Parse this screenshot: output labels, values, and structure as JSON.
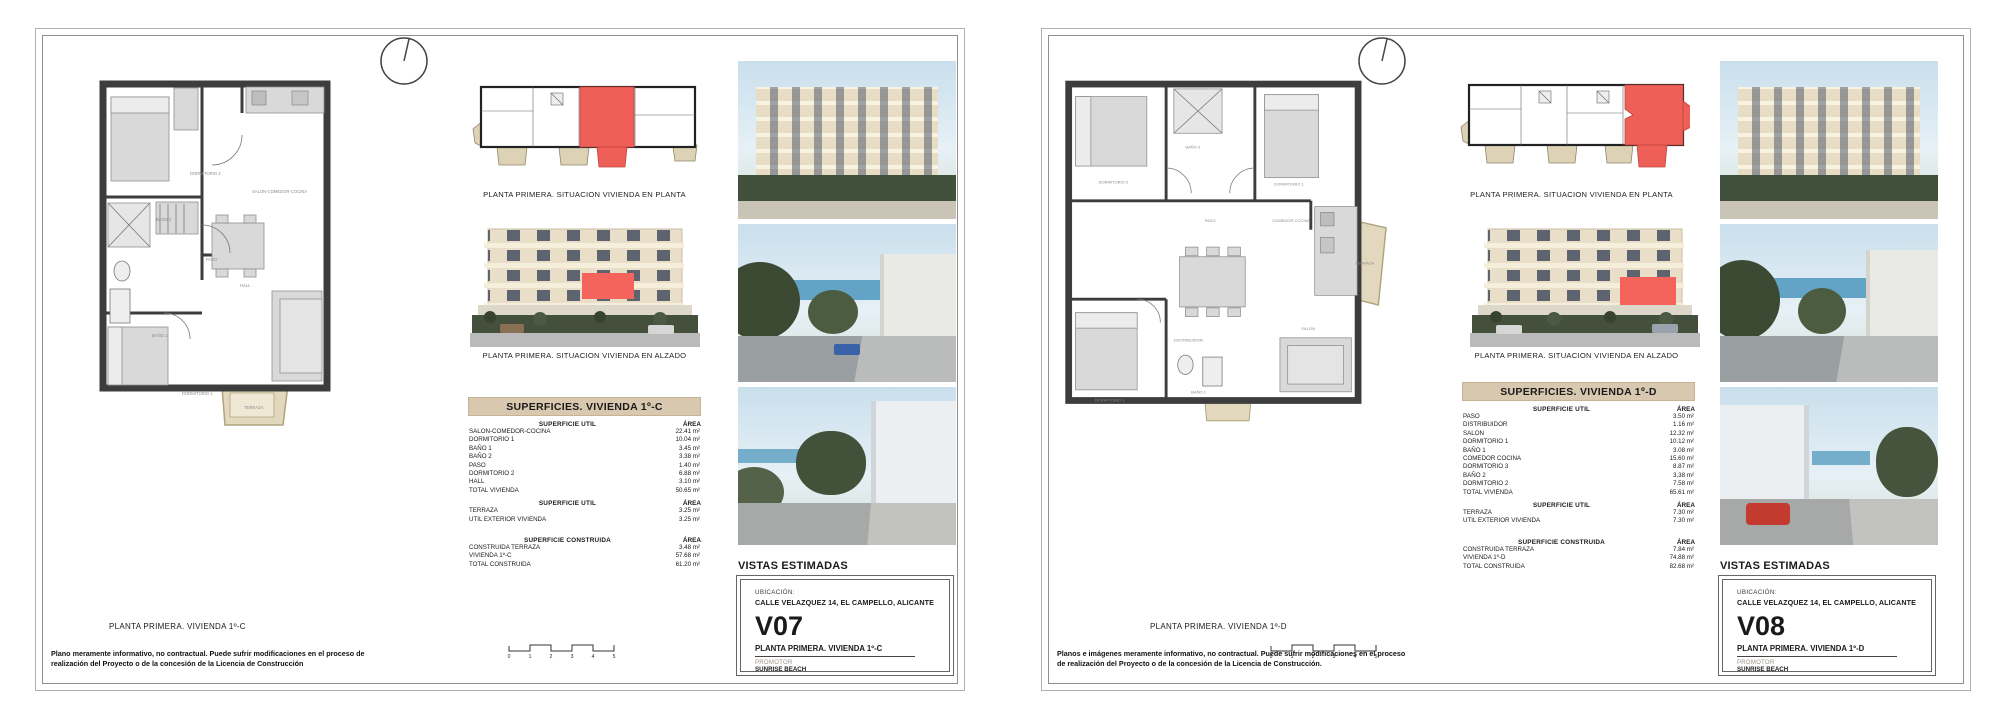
{
  "colors": {
    "highlight_red": "#ee5f58",
    "terrace_beige": "#e2d8bd",
    "wall_dark": "#3d3d3d",
    "table_header_bg": "#d8c8b0",
    "hedge_green": "#434f39",
    "sea_blue": "#62a3c6"
  },
  "sheets": [
    {
      "code": "V07",
      "captions": {
        "situacion_planta": "PLANTA PRIMERA. SITUACION VIVIENDA EN PLANTA",
        "situacion_alzado": "PLANTA PRIMERA. SITUACION VIVIENDA EN ALZADO",
        "plan": "PLANTA PRIMERA. VIVIENDA 1º-C",
        "vistas": "VISTAS ESTIMADAS"
      },
      "rooms": {
        "r1": "DORMITORIO 2",
        "r2": "BAÑO 2",
        "r3": "BAÑO 1",
        "r4": "DORMITORIO 1",
        "r5": "PASO",
        "r6": "HALL",
        "r7": "SALON-COMEDOR-COCINA",
        "r8": "TERRAZA"
      },
      "table": {
        "title": "SUPERFICIES. VIVIENDA 1º-C",
        "sections": [
          {
            "header": "SUPERFICIE UTIL",
            "area_label": "ÁREA",
            "rows": [
              [
                "SALON-COMEDOR-COCINA",
                "22.41 m²"
              ],
              [
                "DORMITORIO 1",
                "10.04 m²"
              ],
              [
                "BAÑO 1",
                "3.45 m²"
              ],
              [
                "BAÑO 2",
                "3.38 m²"
              ],
              [
                "PASO",
                "1.40 m²"
              ],
              [
                "DORMITORIO 2",
                "6.88 m²"
              ],
              [
                "HALL",
                "3.10 m²"
              ],
              [
                "TOTAL VIVIENDA",
                "50.65 m²"
              ]
            ]
          },
          {
            "header": "SUPERFICIE UTIL",
            "area_label": "ÁREA",
            "rows": [
              [
                "TERRAZA",
                "3.25 m²"
              ],
              [
                "UTIL EXTERIOR VIVIENDA",
                "3.25 m²"
              ]
            ]
          },
          {
            "header": "SUPERFICIE CONSTRUIDA",
            "area_label": "ÁREA",
            "rows": [
              [
                "CONSTRUIDA TERRAZA",
                "3.48 m²"
              ],
              [
                "VIVIENDA 1º-C",
                "57.68 m²"
              ],
              [
                "TOTAL CONSTRUIDA",
                "61.20 m²"
              ]
            ]
          }
        ]
      },
      "title_block": {
        "ubicacion_label": "UBICACIÓN:",
        "address": "CALLE VELAZQUEZ 14, EL CAMPELLO, ALICANTE",
        "code": "V07",
        "plan_name": "PLANTA PRIMERA. VIVIENDA 1º-C",
        "promotor_label": "PROMOTOR",
        "promotor_name": "SUNRISE BEACH"
      },
      "disclaimer": "Plano meramente informativo, no contractual. Puede sufrir modificaciones en el proceso de realización del Proyecto o de la concesión de la Licencia de Construcción",
      "scale_ticks": [
        "0",
        "1",
        "2",
        "3",
        "4",
        "5"
      ]
    },
    {
      "code": "V08",
      "captions": {
        "situacion_planta": "PLANTA PRIMERA. SITUACION VIVIENDA EN PLANTA",
        "situacion_alzado": "PLANTA PRIMERA. SITUACION VIVIENDA EN ALZADO",
        "plan": "PLANTA PRIMERA. VIVIENDA 1º-D",
        "vistas": "VISTAS ESTIMADAS"
      },
      "rooms": {
        "r1": "DORMITORIO 2",
        "r2": "BAÑO 2",
        "r3": "DORMITORIO 1",
        "r4": "COMEDOR COCINA",
        "r5": "PASO",
        "r6": "DISTRIBUIDOR",
        "r7": "SALON",
        "r8": "DORMITORIO 3",
        "r9": "BAÑO 1",
        "r10": "TERRAZA"
      },
      "table": {
        "title": "SUPERFICIES. VIVIENDA 1º-D",
        "sections": [
          {
            "header": "SUPERFICIE UTIL",
            "area_label": "ÁREA",
            "rows": [
              [
                "PASO",
                "3.50 m²"
              ],
              [
                "DISTRIBUIDOR",
                "1.16 m²"
              ],
              [
                "SALON",
                "12.32 m²"
              ],
              [
                "DORMITORIO 1",
                "10.12 m²"
              ],
              [
                "BAÑO 1",
                "3.08 m²"
              ],
              [
                "COMEDOR COCINA",
                "15.60 m²"
              ],
              [
                "DORMITORIO 3",
                "8.87 m²"
              ],
              [
                "BAÑO 2",
                "3.38 m²"
              ],
              [
                "DORMITORIO 2",
                "7.58 m²"
              ],
              [
                "TOTAL VIVIENDA",
                "65.61 m²"
              ]
            ]
          },
          {
            "header": "SUPERFICIE UTIL",
            "area_label": "ÁREA",
            "rows": [
              [
                "TERRAZA",
                "7.30 m²"
              ],
              [
                "UTIL EXTERIOR VIVIENDA",
                "7.30 m²"
              ]
            ]
          },
          {
            "header": "SUPERFICIE CONSTRUIDA",
            "area_label": "ÁREA",
            "rows": [
              [
                "CONSTRUIDA TERRAZA",
                "7.84 m²"
              ],
              [
                "VIVIENDA 1º-D",
                "74.88 m²"
              ],
              [
                "TOTAL CONSTRUIDA",
                "82.68 m²"
              ]
            ]
          }
        ]
      },
      "title_block": {
        "ubicacion_label": "UBICACIÓN:",
        "address": "CALLE VELAZQUEZ 14, EL CAMPELLO, ALICANTE",
        "code": "V08",
        "plan_name": "PLANTA PRIMERA. VIVIENDA 1º-D",
        "promotor_label": "PROMOTOR",
        "promotor_name": "SUNRISE BEACH"
      },
      "disclaimer": "Planos e imágenes meramente informativo, no contractual. Puede sufrir modificaciones en el proceso de realización del Proyecto o de la concesión de la Licencia de Construcción.",
      "scale_ticks": [
        "0",
        "1",
        "2",
        "3",
        "4",
        "5"
      ]
    }
  ]
}
